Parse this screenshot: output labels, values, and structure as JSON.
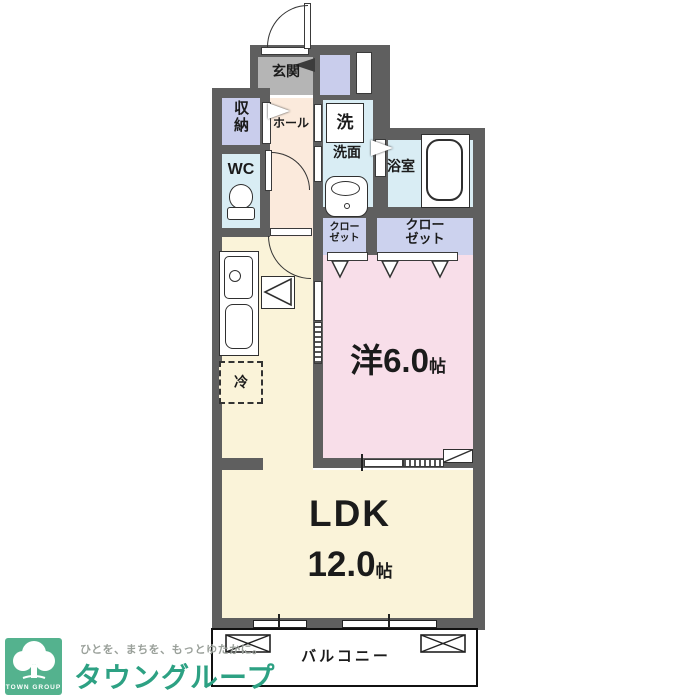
{
  "plan": {
    "rooms": {
      "genkan": {
        "label": "玄関"
      },
      "hall": {
        "label": "ホール"
      },
      "storage": {
        "label": "収納"
      },
      "wc": {
        "label": "WC"
      },
      "washer": {
        "label": "洗"
      },
      "washroom": {
        "label": "洗面"
      },
      "bathroom": {
        "label": "浴室"
      },
      "closet_small": {
        "label": "クローゼット"
      },
      "closet_large": {
        "label": "クローゼット"
      },
      "western": {
        "label": "洋6.0",
        "unit": "帖"
      },
      "ldk": {
        "title": "LDK",
        "size": "12.0",
        "unit": "帖"
      },
      "fridge": {
        "label": "冷"
      },
      "balcony": {
        "label": "バルコニー"
      }
    },
    "colors": {
      "wall": "#5f5f5f",
      "genkan_floor": "#b5b5b5",
      "hall_floor": "#fbeadc",
      "storage_fill": "#c9cdec",
      "wet_area_fill": "#d9edf4",
      "closet_fill": "#ccd2ee",
      "western_room_fill": "#f8dee9",
      "ldk_fill": "#faf3d9"
    }
  },
  "logo": {
    "badge_text": "TOWN GROUP",
    "tagline": "ひとを、まちを、もっとゆたかに。",
    "brand": "タウングループ",
    "green": "#54b28e",
    "brand_green": "#2da183"
  }
}
